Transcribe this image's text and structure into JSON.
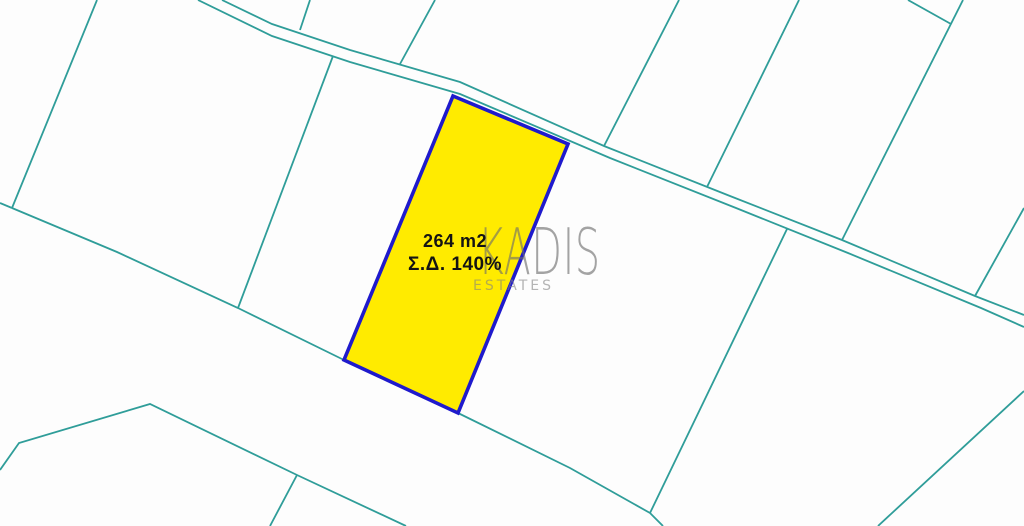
{
  "app": {
    "type": "cadastral-parcel-map"
  },
  "parcel": {
    "area_label": "264 m2",
    "density_label": "Σ.Δ. 140%",
    "fill_color": "#FFEB00",
    "border_color": "#1F1ACC",
    "points": "453,96 568,144 458,413 344,360"
  },
  "watermark": {
    "brand": "KADIS",
    "subtitle": "ESTATES"
  },
  "map": {
    "background_color": "#FDFDFD",
    "boundary_color": "#2F9D99",
    "boundary_lines": [
      {
        "name": "west-parcel-edge",
        "points": "97,0 12,208"
      },
      {
        "name": "west-edge-stub",
        "points": "0,203 12,208"
      },
      {
        "name": "main-lower-boundary",
        "points": "12,208 117,252 238,308 344,360 458,413 570,468 650,513"
      },
      {
        "name": "lower-boundary-exit",
        "points": "650,513 663,526"
      },
      {
        "name": "parcel-divider-left",
        "points": "333,56 238,308"
      },
      {
        "name": "parcel-divider-right",
        "points": "787,229 650,513"
      },
      {
        "name": "road-upper-edge",
        "points": "222,0 272,24 350,50 460,82 604,146 730,196 842,240 975,296 1024,315"
      },
      {
        "name": "road-lower-edge",
        "points": "198,0 272,36 350,62 460,94 610,158 736,208 848,253 981,308 1024,327"
      },
      {
        "name": "north-divider-1",
        "points": "310,0 300,30"
      },
      {
        "name": "north-divider-2",
        "points": "435,0 400,64"
      },
      {
        "name": "north-divider-3",
        "points": "679,0 604,146"
      },
      {
        "name": "north-divider-4",
        "points": "799,0 707,187"
      },
      {
        "name": "north-divider-5",
        "points": "963,0 842,240"
      },
      {
        "name": "north-corner-divider",
        "points": "908,0 951,24"
      },
      {
        "name": "east-divider",
        "points": "1024,208 975,296"
      },
      {
        "name": "southwest-ridge",
        "points": "0,470 19,443 150,404 297,475 406,526"
      },
      {
        "name": "southwest-branch",
        "points": "297,475 270,526"
      },
      {
        "name": "southeast-divider",
        "points": "1024,391 878,526"
      }
    ]
  }
}
